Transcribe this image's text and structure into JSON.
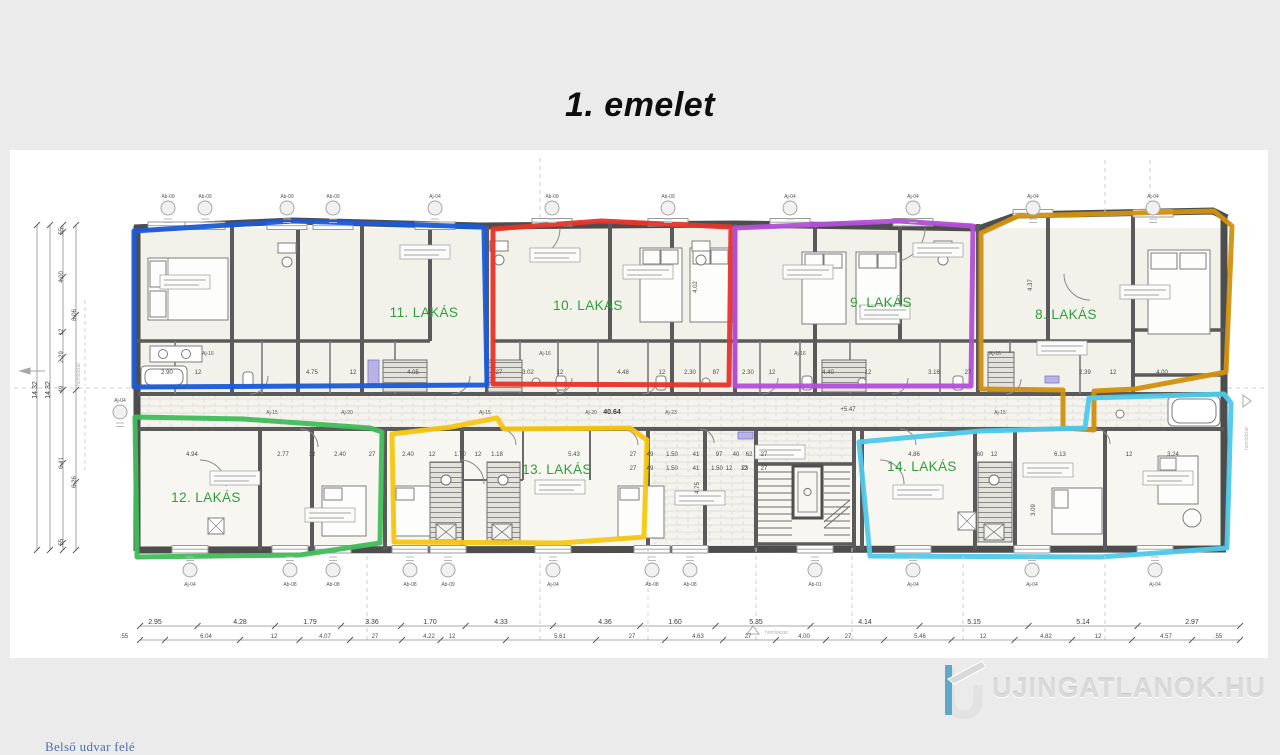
{
  "page": {
    "title": "1. emelet"
  },
  "plan": {
    "label_color": "#2f9e3c",
    "apartments": [
      {
        "label": "11. LAKÁS",
        "color": "#1b5ad7"
      },
      {
        "label": "10. LAKÁS",
        "color": "#e8342a"
      },
      {
        "label": "9. LAKÁS",
        "color": "#b44fd8"
      },
      {
        "label": "8. LAKÁS",
        "color": "#d1910e"
      },
      {
        "label": "12. LAKÁS",
        "color": "#41bd5b"
      },
      {
        "label": "13. LAKÁS",
        "color": "#f7c713"
      },
      {
        "label": "14. LAKÁS",
        "color": "#4ec9ea"
      }
    ]
  },
  "annotations": {
    "courtyard": "Belső udvar felé",
    "corridor_length": "40.64",
    "level_mark": "+5.47",
    "facade": "homlokzat"
  },
  "door_labels": [
    {
      "t": "Aj-15",
      "x": 272
    },
    {
      "t": "Aj-20",
      "x": 347
    },
    {
      "t": "Aj-15",
      "x": 485
    },
    {
      "t": "Aj-20",
      "x": 591
    },
    {
      "t": "Aj-23",
      "x": 671
    },
    {
      "t": "Aj-15",
      "x": 1000
    }
  ],
  "bath_door_labels": [
    {
      "t": "Aj-16",
      "x": 208
    },
    {
      "t": "Aj-16",
      "x": 545
    },
    {
      "t": "Aj-16",
      "x": 800
    },
    {
      "t": "Aj-16",
      "x": 995
    }
  ],
  "markers_top": [
    {
      "t": "Ab-09",
      "x": 168
    },
    {
      "t": "Ab-09",
      "x": 205
    },
    {
      "t": "Ab-09",
      "x": 287
    },
    {
      "t": "Ab-09",
      "x": 333
    },
    {
      "t": "Aj-04",
      "x": 435
    },
    {
      "t": "Ab-09",
      "x": 552
    },
    {
      "t": "Ab-09",
      "x": 668
    },
    {
      "t": "Aj-04",
      "x": 790
    },
    {
      "t": "Aj-04",
      "x": 913
    },
    {
      "t": "Aj-04",
      "x": 1033
    },
    {
      "t": "Aj-04",
      "x": 1153
    }
  ],
  "markers_bottom": [
    {
      "t": "Aj-04",
      "x": 190
    },
    {
      "t": "Ab-08",
      "x": 290
    },
    {
      "t": "Ab-08",
      "x": 333
    },
    {
      "t": "Ab-08",
      "x": 410
    },
    {
      "t": "Ab-09",
      "x": 448
    },
    {
      "t": "Aj-04",
      "x": 553
    },
    {
      "t": "Ab-08",
      "x": 652
    },
    {
      "t": "Ab-08",
      "x": 690
    },
    {
      "t": "Ab-01",
      "x": 815
    },
    {
      "t": "Aj-04",
      "x": 913
    },
    {
      "t": "Aj-04",
      "x": 1032
    },
    {
      "t": "Aj-04",
      "x": 1155
    }
  ],
  "dims": {
    "left_total_1": "14.32",
    "left_total_2": "14.32",
    "left_segments": [
      {
        "t": ".55",
        "y": 232
      },
      {
        "t": "4.00",
        "y": 277
      },
      {
        "t": "12",
        "y": 332
      },
      {
        "t": "2.29",
        "y": 357
      },
      {
        "t": ".49",
        "y": 390
      },
      {
        "t": "6.41",
        "y": 463
      },
      {
        "t": ".55",
        "y": 543
      }
    ],
    "left_inner": [
      {
        "t": "8.06",
        "y": 315
      },
      {
        "t": "6.26",
        "y": 482
      }
    ],
    "bottom_row1": [
      {
        "t": "2.95",
        "x": 155
      },
      {
        "t": "4.28",
        "x": 240
      },
      {
        "t": "1.79",
        "x": 310
      },
      {
        "t": "3.36",
        "x": 372
      },
      {
        "t": "1.70",
        "x": 430
      },
      {
        "t": "4.33",
        "x": 501
      },
      {
        "t": "4.36",
        "x": 605
      },
      {
        "t": "1.60",
        "x": 675
      },
      {
        "t": "5.35",
        "x": 756
      },
      {
        "t": "4.14",
        "x": 865
      },
      {
        "t": "5.15",
        "x": 974
      },
      {
        "t": "5.14",
        "x": 1083
      },
      {
        "t": "2.97",
        "x": 1192
      }
    ],
    "bottom_row2": [
      {
        "t": ".55",
        "x": 124
      },
      {
        "t": "6.04",
        "x": 206
      },
      {
        "t": "12",
        "x": 274
      },
      {
        "t": "4.07",
        "x": 325
      },
      {
        "t": "27",
        "x": 375
      },
      {
        "t": "4.22",
        "x": 429
      },
      {
        "t": "12",
        "x": 452
      },
      {
        "t": "5.61",
        "x": 560
      },
      {
        "t": "27",
        "x": 632
      },
      {
        "t": "4.63",
        "x": 698
      },
      {
        "t": "27",
        "x": 748
      },
      {
        "t": "4.00",
        "x": 804
      },
      {
        "t": "27",
        "x": 848
      },
      {
        "t": "5.46",
        "x": 920
      },
      {
        "t": "12",
        "x": 983
      },
      {
        "t": "4.82",
        "x": 1046
      },
      {
        "t": "12",
        "x": 1098
      },
      {
        "t": "4.57",
        "x": 1166
      },
      {
        "t": ".55",
        "x": 1218
      }
    ],
    "inner_top": [
      {
        "t": "2.90",
        "x": 167
      },
      {
        "t": "12",
        "x": 198
      },
      {
        "t": "4.75",
        "x": 312
      },
      {
        "t": "12",
        "x": 353
      },
      {
        "t": "4.05",
        "x": 413
      },
      {
        "t": "27",
        "x": 499
      },
      {
        "t": "3.02",
        "x": 528
      },
      {
        "t": "12",
        "x": 560
      },
      {
        "t": "4.48",
        "x": 623
      },
      {
        "t": "12",
        "x": 662
      },
      {
        "t": "2.30",
        "x": 690
      },
      {
        "t": "87",
        "x": 716
      },
      {
        "t": "2.30",
        "x": 748
      },
      {
        "t": "12",
        "x": 772
      },
      {
        "t": "4.40",
        "x": 828
      },
      {
        "t": "12",
        "x": 868
      },
      {
        "t": "3.16",
        "x": 934
      },
      {
        "t": "27",
        "x": 968
      },
      {
        "t": "2.39",
        "x": 1085
      },
      {
        "t": "12",
        "x": 1113
      },
      {
        "t": "4.00",
        "x": 1162
      }
    ],
    "inner_bottom": [
      {
        "t": "4.94",
        "x": 192
      },
      {
        "t": "2.77",
        "x": 283
      },
      {
        "t": "12",
        "x": 312
      },
      {
        "t": "2.40",
        "x": 340
      },
      {
        "t": "27",
        "x": 372
      },
      {
        "t": "2.40",
        "x": 408
      },
      {
        "t": "12",
        "x": 432
      },
      {
        "t": "1.70",
        "x": 460
      },
      {
        "t": "12",
        "x": 478
      },
      {
        "t": "1.18",
        "x": 497
      },
      {
        "t": "5.43",
        "x": 574
      },
      {
        "t": "27",
        "x": 633
      },
      {
        "t": "49",
        "x": 650
      },
      {
        "t": "1.50",
        "x": 672
      },
      {
        "t": "41",
        "x": 696
      },
      {
        "t": "97",
        "x": 719
      },
      {
        "t": "40",
        "x": 736
      },
      {
        "t": "62",
        "x": 749
      },
      {
        "t": "27",
        "x": 764
      },
      {
        "t": "4.86",
        "x": 914
      },
      {
        "t": "60",
        "x": 980
      },
      {
        "t": "12",
        "x": 994
      },
      {
        "t": "6.13",
        "x": 1060
      },
      {
        "t": "12",
        "x": 1129
      },
      {
        "t": "3.24",
        "x": 1173
      }
    ],
    "inner_bottom2": [
      {
        "t": "27",
        "x": 633
      },
      {
        "t": "49",
        "x": 650
      },
      {
        "t": "1.50",
        "x": 672
      },
      {
        "t": "41",
        "x": 696
      },
      {
        "t": "1.50",
        "x": 717
      },
      {
        "t": "73",
        "x": 745
      },
      {
        "t": "27",
        "x": 764
      },
      {
        "t": "12",
        "x": 729
      },
      {
        "t": "12",
        "x": 744
      }
    ],
    "verticals": [
      {
        "t": "4.02",
        "x": 697,
        "y": 287
      },
      {
        "t": "4.37",
        "x": 1032,
        "y": 285
      },
      {
        "t": "4.75",
        "x": 699,
        "y": 488
      },
      {
        "t": "3.09",
        "x": 1035,
        "y": 510
      }
    ]
  },
  "watermark": {
    "text": "UJINGATLANOK.HU"
  }
}
